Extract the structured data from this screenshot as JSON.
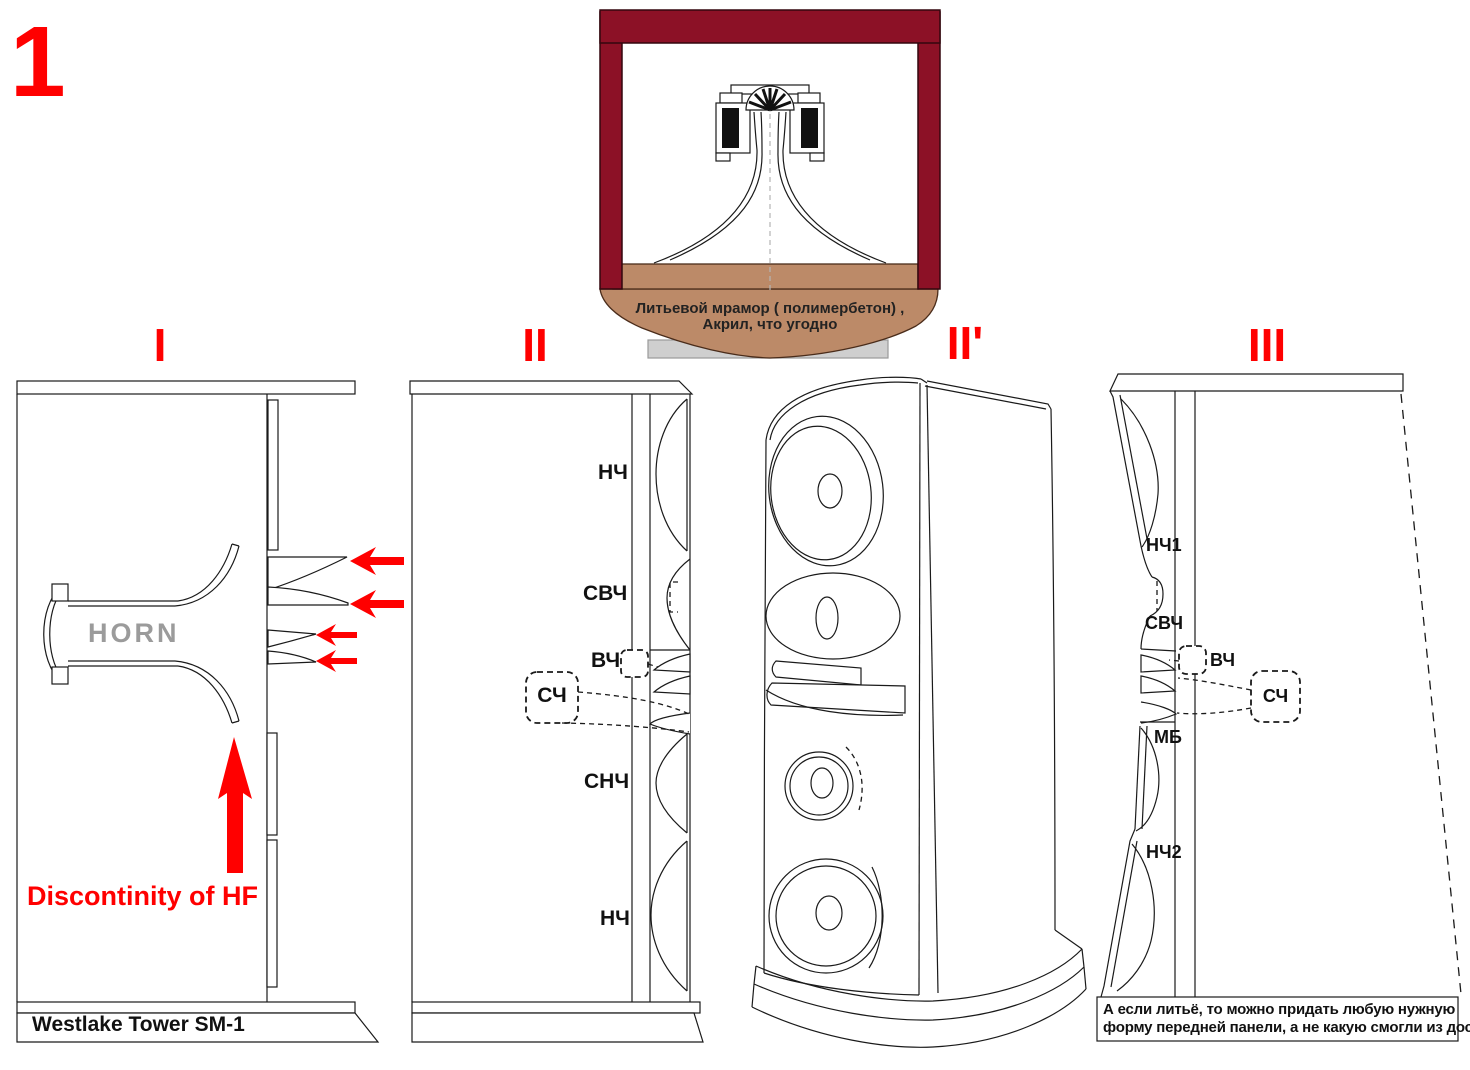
{
  "figure_number": "1",
  "colors": {
    "accent_red": "#ff0000",
    "frame_maroon": "#8c1126",
    "base_brown": "#bc8a68",
    "plinth_gray": "#cfcfcf",
    "horn_text_gray": "#9b9b9b",
    "line_black": "#1a1a1a"
  },
  "sections": [
    {
      "label": "I"
    },
    {
      "label": "II"
    },
    {
      "label": "II'"
    },
    {
      "label": "III"
    }
  ],
  "horn_insert": {
    "material_note_line1": "Литьевой мрамор ( полимербетон) ,",
    "material_note_line2": "Акрил, что угодно"
  },
  "diagram1": {
    "horn_label": "HORN",
    "hf_annotation": "Discontinity of HF",
    "model_name": "Westlake Tower SM-1"
  },
  "diagram2": {
    "driver_labels": [
      "НЧ",
      "СВЧ",
      "ВЧ",
      "СЧ",
      "СНЧ",
      "НЧ"
    ]
  },
  "diagram3": {
    "driver_labels": [
      "НЧ1",
      "СВЧ",
      "ВЧ",
      "СЧ",
      "МБ",
      "НЧ2"
    ],
    "note_line1": "А если литьё, то можно придать любую нужную",
    "note_line2": "форму передней панели, а не какую смогли из доски"
  }
}
